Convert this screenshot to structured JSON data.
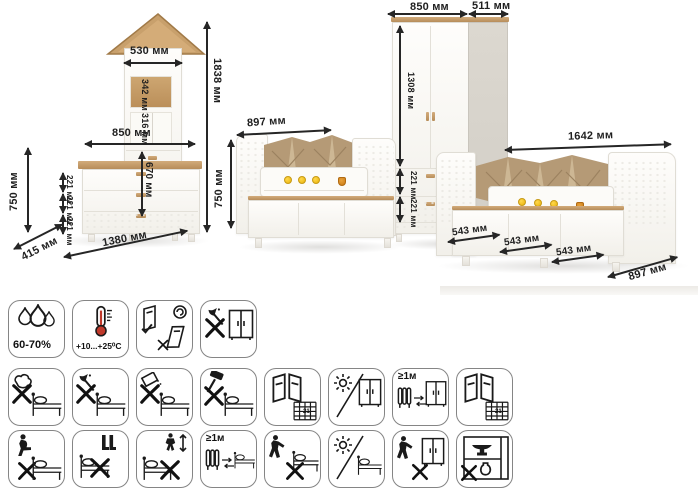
{
  "title": "Детская мебель — схема размеров и пиктограммы ухода",
  "dims": {
    "tower_width": "530 мм",
    "total_height": "1838 мм",
    "dresser_width": "850 мм",
    "dresser_height": "750 мм",
    "dresser_depth": "415 мм",
    "left_total_width": "1380 мм",
    "shelf_top": "342 мм",
    "shelf_middle": "316 мм",
    "tower_door_height": "670 мм",
    "drawer_height": "221 мм",
    "crib_width": "897 мм",
    "crib_height": "750 мм",
    "wardrobe_width": "850 мм",
    "wardrobe_depth": "511 мм",
    "wardrobe_door_height": "1308 мм",
    "bed_length": "1642 мм",
    "bed_drawer_width": "543 мм",
    "bed_depth": "897 мм"
  },
  "colors": {
    "wood": "#c39b69",
    "fabric": "#b59a76",
    "fabric_light": "#cdb794",
    "bee_yellow": "#eab308",
    "honey_amber": "#c97a16",
    "thermometer_red": "#c0392b"
  },
  "icons": {
    "rows": [
      {
        "items": [
          {
            "name": "humidity-range",
            "label": "60-70%"
          },
          {
            "name": "temperature-range",
            "label": "+10...+25⁰С"
          },
          {
            "name": "door-mounting-orientation",
            "label": ""
          },
          {
            "name": "no-sharp-tools-wardrobe",
            "label": ""
          }
        ]
      },
      {
        "items": [
          {
            "name": "no-wet-cleaning-bed",
            "label": ""
          },
          {
            "name": "no-axe-bed",
            "label": ""
          },
          {
            "name": "no-abrasive-powder-bed",
            "label": ""
          },
          {
            "name": "no-hammering-bed",
            "label": ""
          },
          {
            "name": "ventilation-window-days",
            "label": "21"
          },
          {
            "name": "no-direct-sunlight-wardrobe",
            "label": ""
          },
          {
            "name": "heater-distance-wardrobe",
            "label": "≥1м"
          },
          {
            "name": "ventilation-window-days-2",
            "label": "21"
          }
        ]
      },
      {
        "items": [
          {
            "name": "no-sitting-on-edge",
            "label": ""
          },
          {
            "name": "no-standing-on-bed",
            "label": ""
          },
          {
            "name": "no-jumping-on-bed",
            "label": ""
          },
          {
            "name": "heater-distance-bed",
            "label": "≥1м"
          },
          {
            "name": "no-dragging-bed",
            "label": ""
          },
          {
            "name": "no-direct-sunlight-bed",
            "label": ""
          },
          {
            "name": "no-dragging-wardrobe",
            "label": ""
          },
          {
            "name": "no-heavy-items-inside",
            "label": ""
          }
        ]
      }
    ]
  }
}
